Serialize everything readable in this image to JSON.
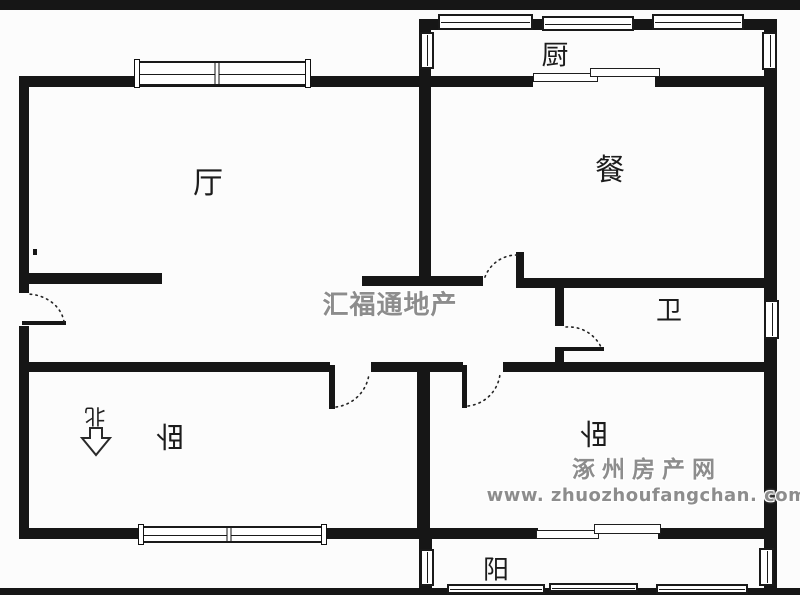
{
  "title": "apartment floor plan",
  "rooms": [
    {
      "name": "living-room",
      "label": "厅",
      "x": 208,
      "y": 180,
      "size": 30,
      "rotated": false
    },
    {
      "name": "dining-room",
      "label": "餐",
      "x": 610,
      "y": 167,
      "size": 30,
      "rotated": false
    },
    {
      "name": "kitchen",
      "label": "厨",
      "x": 555,
      "y": 53,
      "size": 27,
      "rotated": false
    },
    {
      "name": "bathroom",
      "label": "卫",
      "x": 669,
      "y": 309,
      "size": 26,
      "rotated": false
    },
    {
      "name": "bedroom-left",
      "label": "卧",
      "x": 170,
      "y": 438,
      "size": 29,
      "rotated": true
    },
    {
      "name": "bedroom-right",
      "label": "卧",
      "x": 594,
      "y": 435,
      "size": 29,
      "rotated": true
    },
    {
      "name": "balcony",
      "label": "阳",
      "x": 496,
      "y": 568,
      "size": 26,
      "rotated": false
    }
  ],
  "north_indicator": {
    "label": "北",
    "arrow_direction": "down"
  },
  "watermarks": {
    "center": {
      "text": "汇福通地产"
    },
    "corner": {
      "line1": "涿州房产网",
      "line2": "www. zhuozhoufangchan. com"
    }
  },
  "colors": {
    "wall": "#161616",
    "background": "#fcfcfc",
    "watermark": "#8d8d8d"
  },
  "geometry": {
    "walls": [
      [
        0,
        0,
        800,
        10
      ],
      [
        0,
        588,
        800,
        7
      ],
      [
        19,
        76,
        10,
        217
      ],
      [
        19,
        326,
        10,
        213
      ],
      [
        19,
        76,
        412,
        11
      ],
      [
        419,
        19,
        357,
        11
      ],
      [
        419,
        19,
        12,
        266
      ],
      [
        764,
        19,
        13,
        573
      ],
      [
        419,
        76,
        114,
        11
      ],
      [
        655,
        76,
        121,
        11
      ],
      [
        19,
        273,
        143,
        11
      ],
      [
        362,
        276,
        121,
        10
      ],
      [
        516,
        252,
        8,
        34
      ],
      [
        516,
        278,
        260,
        10
      ],
      [
        555,
        281,
        9,
        45
      ],
      [
        555,
        347,
        9,
        25
      ],
      [
        563,
        347,
        41,
        4
      ],
      [
        19,
        362,
        311,
        10
      ],
      [
        371,
        362,
        92,
        10
      ],
      [
        503,
        362,
        273,
        10
      ],
      [
        417,
        362,
        13,
        177
      ],
      [
        19,
        528,
        398,
        11
      ],
      [
        417,
        528,
        121,
        11
      ],
      [
        658,
        528,
        118,
        11
      ],
      [
        419,
        539,
        13,
        53
      ],
      [
        22,
        321,
        44,
        4
      ],
      [
        329,
        365,
        6,
        44
      ],
      [
        462,
        365,
        5,
        43
      ],
      [
        33,
        249,
        4,
        6
      ]
    ],
    "windows_h": [
      {
        "x": 135,
        "y": 61,
        "w": 175,
        "h": 25,
        "dividers": [
          0.47
        ],
        "caps": true
      },
      {
        "x": 438,
        "y": 14,
        "w": 95,
        "h": 16,
        "dividers": [],
        "caps": false
      },
      {
        "x": 542,
        "y": 16,
        "w": 92,
        "h": 15,
        "dividers": [],
        "caps": false
      },
      {
        "x": 652,
        "y": 14,
        "w": 92,
        "h": 16,
        "dividers": [],
        "caps": false
      },
      {
        "x": 139,
        "y": 526,
        "w": 187,
        "h": 17,
        "dividers": [
          0.48
        ],
        "caps": true
      },
      {
        "x": 447,
        "y": 584,
        "w": 98,
        "h": 10,
        "dividers": [],
        "caps": false
      },
      {
        "x": 549,
        "y": 583,
        "w": 89,
        "h": 9,
        "dividers": [],
        "caps": false
      },
      {
        "x": 656,
        "y": 584,
        "w": 92,
        "h": 10,
        "dividers": [],
        "caps": false
      }
    ],
    "windows_v": [
      {
        "x": 420,
        "y": 32,
        "w": 14,
        "h": 37
      },
      {
        "x": 762,
        "y": 32,
        "w": 15,
        "h": 38
      },
      {
        "x": 764,
        "y": 300,
        "w": 15,
        "h": 39
      },
      {
        "x": 420,
        "y": 549,
        "w": 14,
        "h": 37
      },
      {
        "x": 759,
        "y": 548,
        "w": 15,
        "h": 38
      }
    ],
    "sliding_doors": [
      [
        533,
        73,
        65,
        9
      ],
      [
        590,
        68,
        70,
        9
      ],
      [
        536,
        530,
        63,
        9
      ],
      [
        594,
        524,
        67,
        10
      ]
    ],
    "door_arcs": [
      "M 64 322 A 38 32 0 0 0 27 294",
      "M 517 255 A 34 34 0 0 0 484 280",
      "M 566 327 A 36 36 0 0 1 601 347",
      "M 336 407 A 38 38 0 0 0 369 374",
      "M 468 406 A 36 36 0 0 0 500 374"
    ]
  }
}
